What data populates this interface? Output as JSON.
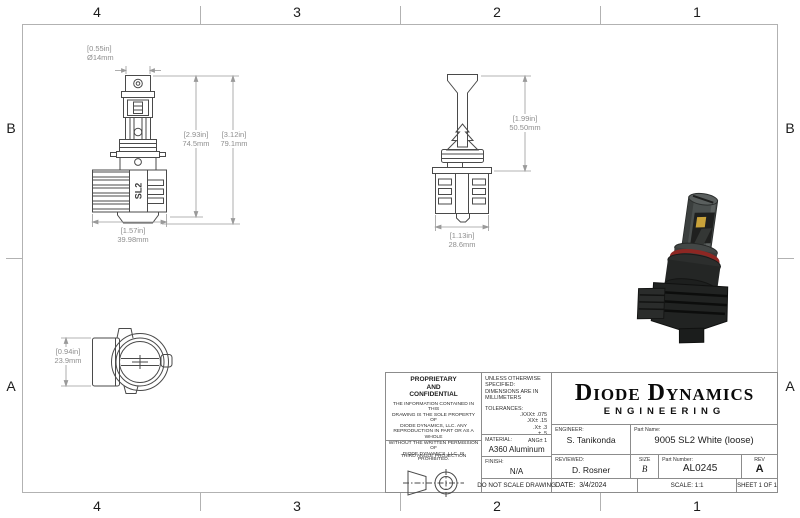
{
  "zones": {
    "cols": [
      "4",
      "3",
      "2",
      "1"
    ],
    "rows": [
      "B",
      "A"
    ]
  },
  "dimensions": {
    "front_cap": {
      "inches": "[0.55in]",
      "mm": "Ø14mm"
    },
    "front_body": {
      "inches": "[2.93in]",
      "mm": "74.5mm"
    },
    "front_total": {
      "inches": "[3.12in]",
      "mm": "79.1mm"
    },
    "front_width": {
      "inches": "[1.57in]",
      "mm": "39.98mm"
    },
    "side_height": {
      "inches": "[1.99in]",
      "mm": "50.50mm"
    },
    "side_width": {
      "inches": "[1.13in]",
      "mm": "28.6mm"
    },
    "top_view_height": {
      "inches": "[0.94in]",
      "mm": "23.9mm"
    }
  },
  "views": {
    "front_logo": "SL2"
  },
  "colors": {
    "oring_red": "#8d2723",
    "led_yellow": "#c9a23a",
    "body_gray": "#4b504f"
  },
  "title_block": {
    "proprietary_heading": "PROPRIETARY\nAND\nCONFIDENTIAL",
    "proprietary_body": "THE INFORMATION CONTAINED IN THIS\nDRAWING IS THE SOLE PROPERTY OF\nDIODE DYNAMICS, LLC.  ANY\nREPRODUCTION IN PART OR AS A WHOLE\nWITHOUT THE WRITTEN PERMISSION OF\nDIODE DYNAMICS, LLC. IS PROHIBITED.",
    "third_angle_label": "THIRD ANGLE PROJECTION",
    "unless_line1": "UNLESS OTHERWISE SPECIFIED:",
    "unless_line2": "DIMENSIONS ARE IN MILLIMETERS",
    "tolerances_label": "TOLERANCES:",
    "tolerances": [
      ".XXX± .075",
      ".XX± .15",
      ".X± .3",
      "± .5",
      "ANG± 1"
    ],
    "material_label": "MATERIAL:",
    "material_value": "A360 Aluminum",
    "finish_label": "FINISH:",
    "finish_value": "N/A",
    "do_not_scale": "DO NOT SCALE DRAWING",
    "company_name": "Diode Dynamics",
    "company_sub": "ENGINEERING",
    "engineer_label": "ENGINEER:",
    "engineer_value": "S. Tanikonda",
    "part_name_label": "Part Name:",
    "part_name_value": "9005 SL2 White (loose)",
    "reviewed_label": "REVIEWED:",
    "reviewed_value": "D. Rosner",
    "size_label": "SIZE",
    "size_value": "B",
    "part_number_label": "Part Number:",
    "part_number_value": "AL0245",
    "rev_label": "REV",
    "rev_value": "A",
    "date_label": "DATE:",
    "date_value": "3/4/2024",
    "scale_text": "SCALE: 1:1",
    "sheet_text": "SHEET 1 OF 1"
  }
}
